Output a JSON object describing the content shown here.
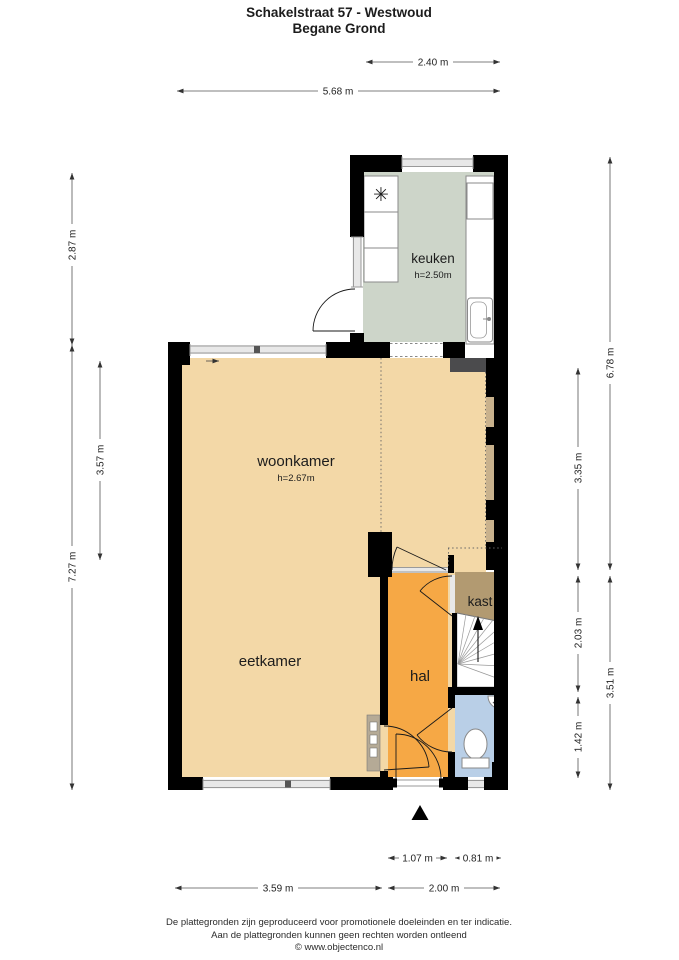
{
  "title": {
    "line1": "Schakelstraat 57 - Westwoud",
    "line2": "Begane Grond"
  },
  "rooms": {
    "keuken": {
      "label": "keuken",
      "ceiling": "h=2.50m"
    },
    "woonkamer": {
      "label": "woonkamer",
      "ceiling": "h=2.67m"
    },
    "eetkamer": {
      "label": "eetkamer"
    },
    "hal": {
      "label": "hal"
    },
    "kast": {
      "label": "kast"
    }
  },
  "dimensions": {
    "top": {
      "w240": "2.40 m",
      "w568": "5.68 m"
    },
    "left": {
      "h287": "2.87 m",
      "h727": "7.27 m",
      "h357": "3.57 m"
    },
    "right": {
      "h335": "3.35 m",
      "h203": "2.03 m",
      "h142": "1.42 m",
      "h678": "6.78 m",
      "h351": "3.51 m"
    },
    "bottom": {
      "w107": "1.07 m",
      "w081": "0.81 m",
      "w359": "3.59 m",
      "w200": "2.00 m"
    }
  },
  "footer": {
    "line1": "De plattegronden zijn geproduceerd voor promotionele doeleinden en ter indicatie.",
    "line2": "Aan de plattegronden kunnen geen rechten worden ontleend",
    "line3": "© www.objectenco.nl"
  },
  "colors": {
    "wall": "#000000",
    "keuken_floor": "#cdd5c9",
    "living_floor": "#f3d8a7",
    "hal_floor": "#f6a845",
    "kast_floor": "#b29a71",
    "toilet_floor": "#b9cfe7",
    "bay_window": "#c9b28d",
    "radiator": "#4b4b4d"
  }
}
